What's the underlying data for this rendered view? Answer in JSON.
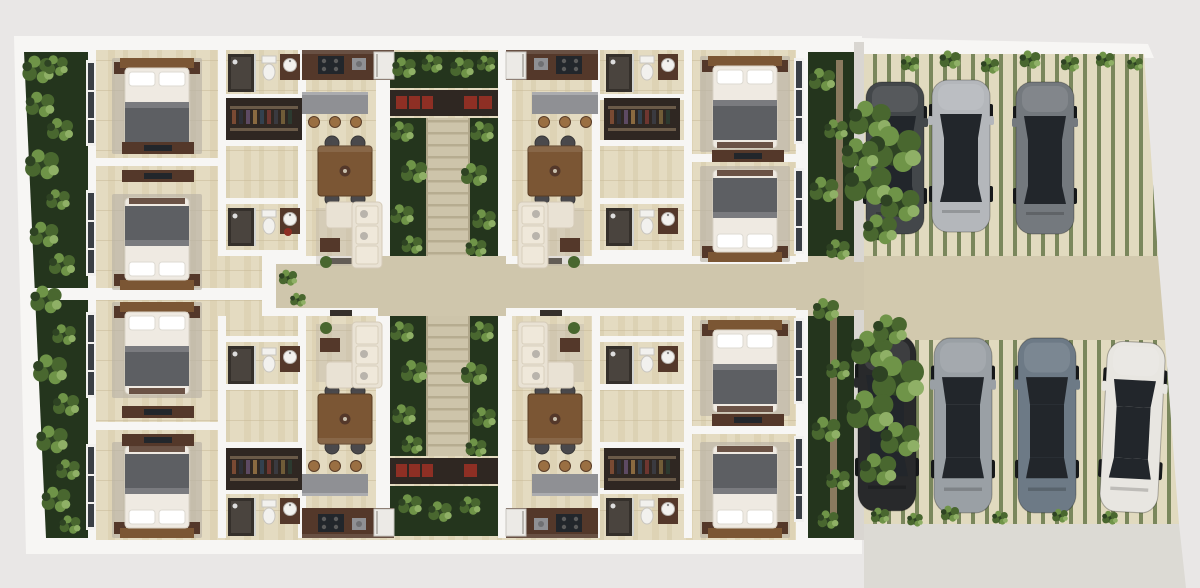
{
  "scene": {
    "type": "residential-apartment-floor-plan-3d-render",
    "view": "top-down",
    "building": {
      "units": [
        {
          "id": "unit-top-left",
          "rooms": [
            "bedroom",
            "bedroom",
            "bathroom",
            "bathroom",
            "walk-in-closet",
            "kitchen",
            "dining",
            "living"
          ]
        },
        {
          "id": "unit-top-right",
          "rooms": [
            "bedroom",
            "bedroom",
            "bathroom",
            "bathroom",
            "walk-in-closet",
            "kitchen",
            "dining",
            "living"
          ]
        },
        {
          "id": "unit-bottom-left",
          "rooms": [
            "bedroom",
            "bedroom",
            "bathroom",
            "bathroom",
            "walk-in-closet",
            "kitchen",
            "dining",
            "living"
          ]
        },
        {
          "id": "unit-bottom-right",
          "rooms": [
            "bedroom",
            "bedroom",
            "bathroom",
            "bathroom",
            "walk-in-closet",
            "kitchen",
            "dining",
            "living"
          ]
        }
      ],
      "circulation": {
        "stair_flights": 2,
        "central_walkway": true,
        "red_bench_niches": 2
      }
    },
    "landscape": {
      "left_garden_strip": true,
      "right_garden_strip": true,
      "stair_planter_beds": 6,
      "trees": 2,
      "perimeter_vines": true
    },
    "parking": {
      "surface": "striped-grass-pavers",
      "driveway": "central-horizontal",
      "rows": [
        {
          "id": "top-row",
          "cars": [
            {
              "name": "suv-charcoal-under-tree",
              "color": "#43474a"
            },
            {
              "name": "suv-silver",
              "color": "#b4b7bb"
            },
            {
              "name": "sedan-gray",
              "color": "#74797e"
            }
          ]
        },
        {
          "id": "bottom-row",
          "cars": [
            {
              "name": "sedan-black-under-tree",
              "color": "#28292b"
            },
            {
              "name": "hatchback-silver-black-roof",
              "color": "#9aa0a5"
            },
            {
              "name": "sedan-blue-gray",
              "color": "#6d7a86"
            },
            {
              "name": "sedan-white",
              "color": "#e8e6e1"
            }
          ]
        }
      ]
    }
  },
  "colors": {
    "bg_outer": "#e9e7e6",
    "wall_white": "#f7f6f4",
    "wall_shadow": "#d9d6d1",
    "floor_tile": "#e4dbc1",
    "floor_streak1": "#d8cba6",
    "floor_streak2": "#cdbf9b",
    "grout": "#c6b896",
    "walkway": "#cfc6ac",
    "driveway": "#d2c9ae",
    "sidewalk": "#dcdad4",
    "stair": "#cdc4aa",
    "stair_step": "#b0a68a",
    "garden_base": "#24351d",
    "plant_dark": "#2e4323",
    "plant_mid": "#49672f",
    "plant_light": "#6f9448",
    "plant_pale": "#8fb066",
    "paver_base": "#e1dabf",
    "paver_stripe": "#7a875c",
    "wood_dark": "#54382a",
    "wood_mid": "#7b5634",
    "wood_light": "#9a6f42",
    "counter_gray": "#8f9094",
    "closet_dark": "#2f2722",
    "bed_white": "#efeae2",
    "bed_blanket": "#5d5f63",
    "rug": "#b9b2a6",
    "sofa_cream": "#e9e2d4",
    "fixture_white": "#f2f1ee",
    "fixture_dark": "#35302b",
    "accent_red": "#8e2f24",
    "glass_dark": "#22262b",
    "wheel": "#17191b",
    "tree_trunk": "#8a7a5f"
  }
}
